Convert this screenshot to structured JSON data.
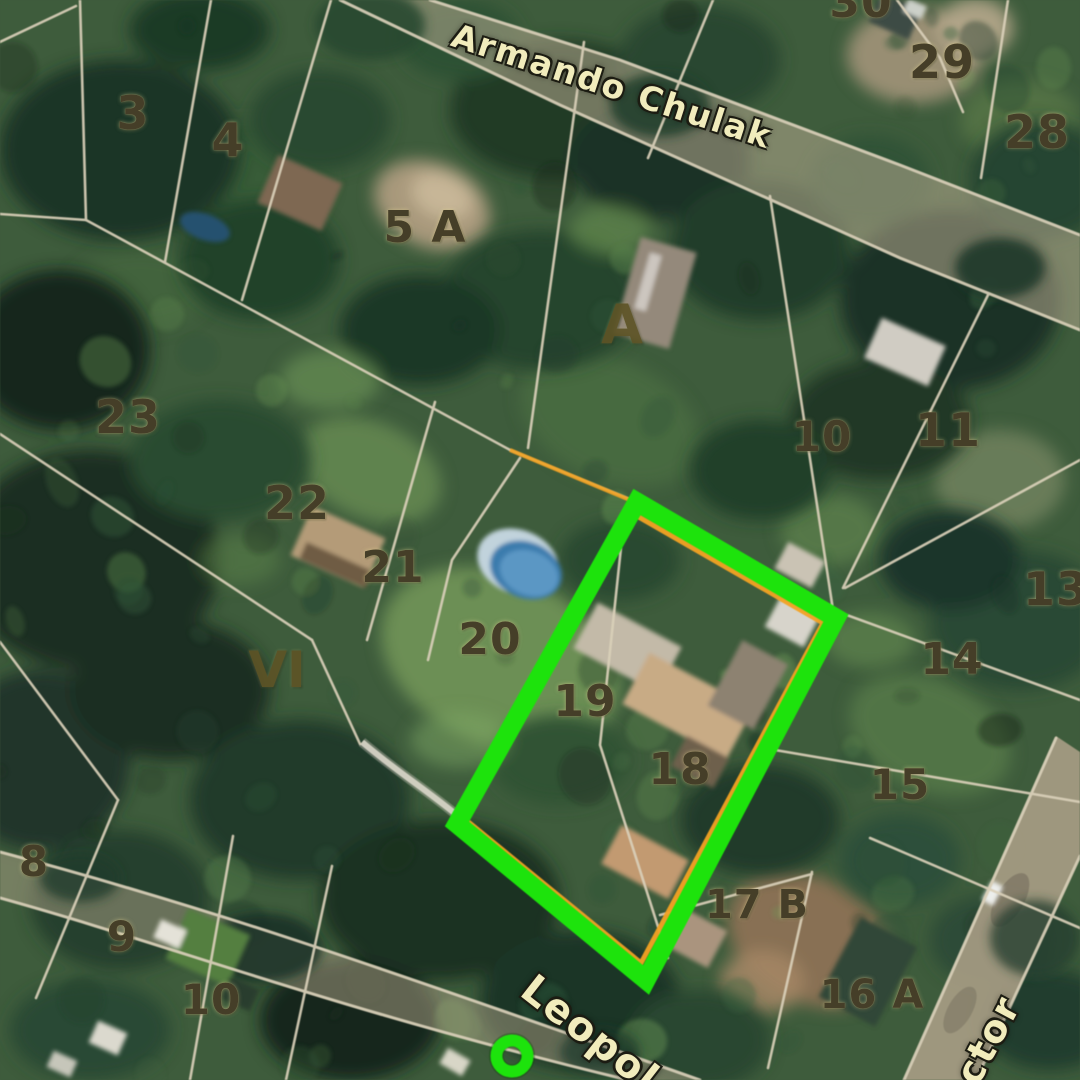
{
  "map": {
    "streets": [
      {
        "name": "street-label-armando-chulak",
        "text": "Armando Chulak",
        "x": 612,
        "y": 86,
        "rot": 18,
        "size": 33
      },
      {
        "name": "street-label-leopol",
        "text": "Leopol",
        "x": 590,
        "y": 1034,
        "rot": 38,
        "size": 40
      },
      {
        "name": "street-label-ctor",
        "text": "ctor",
        "x": 988,
        "y": 1040,
        "rot": -62,
        "size": 38
      }
    ],
    "parcels": [
      {
        "text": "3",
        "x": 133,
        "y": 113,
        "size": 46
      },
      {
        "text": "4",
        "x": 228,
        "y": 140,
        "size": 46
      },
      {
        "text": "5 A",
        "x": 425,
        "y": 228,
        "size": 44
      },
      {
        "text": "30",
        "x": 861,
        "y": 3,
        "size": 44
      },
      {
        "text": "29",
        "x": 942,
        "y": 62,
        "size": 46
      },
      {
        "text": "28",
        "x": 1037,
        "y": 132,
        "size": 46
      },
      {
        "text": "23",
        "x": 128,
        "y": 417,
        "size": 46
      },
      {
        "text": "22",
        "x": 297,
        "y": 503,
        "size": 46
      },
      {
        "text": "21",
        "x": 393,
        "y": 568,
        "size": 44
      },
      {
        "text": "20",
        "x": 490,
        "y": 640,
        "size": 44
      },
      {
        "text": "19",
        "x": 585,
        "y": 702,
        "size": 44
      },
      {
        "text": "18",
        "x": 680,
        "y": 770,
        "size": 44
      },
      {
        "text": "10",
        "x": 822,
        "y": 437,
        "size": 42
      },
      {
        "text": "11",
        "x": 948,
        "y": 430,
        "size": 46
      },
      {
        "text": "13",
        "x": 1056,
        "y": 589,
        "size": 46
      },
      {
        "text": "14",
        "x": 952,
        "y": 660,
        "size": 44
      },
      {
        "text": "15",
        "x": 900,
        "y": 785,
        "size": 42
      },
      {
        "text": "17 B",
        "x": 757,
        "y": 905,
        "size": 40
      },
      {
        "text": "16 A",
        "x": 872,
        "y": 995,
        "size": 40
      },
      {
        "text": "8",
        "x": 34,
        "y": 862,
        "size": 42
      },
      {
        "text": "9",
        "x": 122,
        "y": 937,
        "size": 42
      },
      {
        "text": "10",
        "x": 211,
        "y": 1000,
        "size": 42
      }
    ],
    "sections": [
      {
        "text": "VI",
        "x": 277,
        "y": 670,
        "size": 50
      },
      {
        "text": "A",
        "x": 622,
        "y": 325,
        "size": 54
      }
    ],
    "annotations": {
      "highlight_color": "#22e112",
      "parcel_outline_color": "#f0a228",
      "marker": "ring"
    },
    "palette": {
      "cadastral_line": "#d9d0ba",
      "road_fill": "#b4a98f",
      "parcel_number_color": "#453e28",
      "street_text_color": "#f1ecbc"
    }
  }
}
